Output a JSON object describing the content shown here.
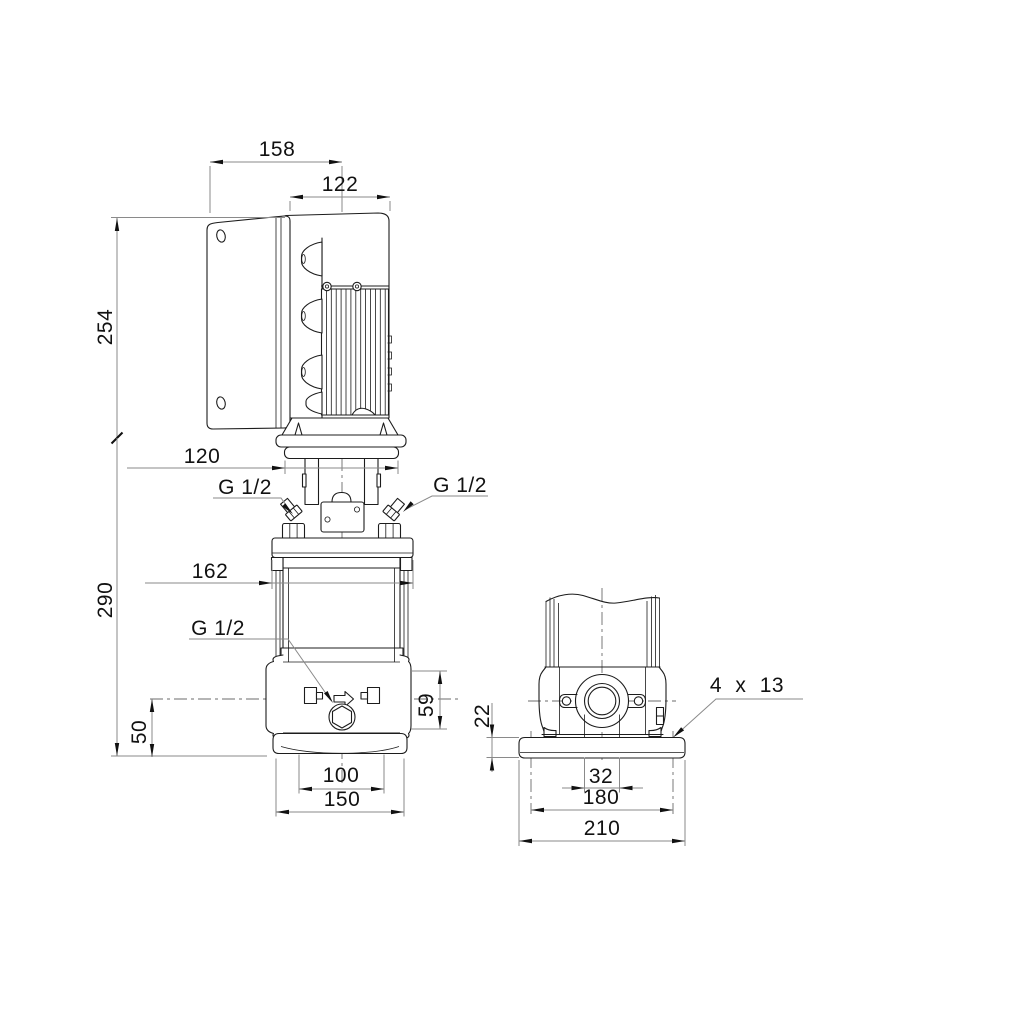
{
  "drawing": {
    "type": "pump-dimensional-drawing",
    "views": [
      "front-elevation-with-motor",
      "side-elevation-base"
    ],
    "line_color": "#1c1c1c",
    "dim_color": "#8a8a8a",
    "dims": {
      "front": {
        "overall_width": "158",
        "converter_width": "122",
        "motor_height": "254",
        "stool_flange_width": "120",
        "pump_height": "290",
        "head_flange_width": "162",
        "vent_plug_left": "G 1/2",
        "vent_plug_right": "G 1/2",
        "drain_plug": "G 1/2",
        "port_flange_height": "59",
        "port_centerline_height": "50",
        "base_inner_width": "100",
        "base_width": "150"
      },
      "side": {
        "base_plate_thickness": "22",
        "foundation_holes": "4 x 13",
        "port_width": "32",
        "hole_spacing": "180",
        "base_plate_width": "210"
      }
    }
  }
}
